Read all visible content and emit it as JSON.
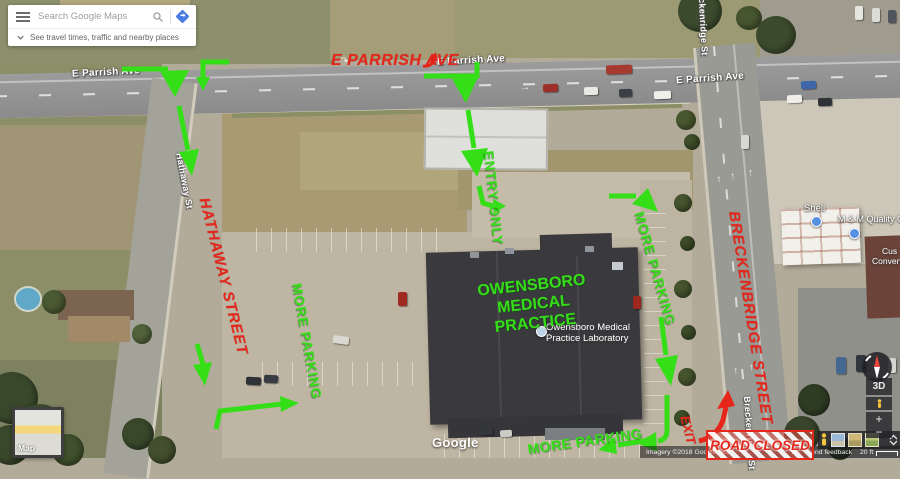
{
  "app": {
    "search_placeholder": "Search Google Maps",
    "travel_bar_text": "See travel times, traffic and nearby places"
  },
  "annotations": {
    "color_red": "#e6261b",
    "color_green": "#35df17",
    "e_parrish": "E PARRISH AVE",
    "hathaway": "HATHAWAY STREET",
    "breckenbridge": "BRECKENBRIDGE STREET",
    "exit": "EXIT",
    "road_closed": "ROAD CLOSED",
    "entry_only": "ENTRY ONLY",
    "more_parking_left": "MORE PARKING",
    "more_parking_right": "MORE PARKING",
    "more_parking_bottom": "MORE PARKING",
    "practice_line1": "OWENSBORO MEDICAL",
    "practice_line2": "PRACTICE"
  },
  "street_labels": {
    "e_parrish_1": "E Parrish Ave",
    "e_parrish_2": "E Parrish Ave",
    "e_parrish_3": "E Parrish Ave",
    "hathaway_st": "Hathaway St",
    "breckenridge_st_top": "Breckenridge St",
    "breckenridge_st_bottom": "Breckenridge St"
  },
  "place_labels": {
    "lab_line1": "Owensboro Medical",
    "lab_line2": "Practice Laboratory",
    "shell": "Shell",
    "mm_quality": "M & M Quality One",
    "partial_1": "Cus",
    "partial_2": "Conven"
  },
  "controls": {
    "map_toggle_label": "Map",
    "tilt_label": "3D",
    "zoom_in": "+",
    "zoom_out": "−"
  },
  "footer": {
    "google_logo": "Google",
    "attribution_left": "Imagery ©2018 Google, Ma",
    "attribution_terms_partial": "ms",
    "send_feedback": "Send feedback",
    "scale_label": "20 ft"
  }
}
